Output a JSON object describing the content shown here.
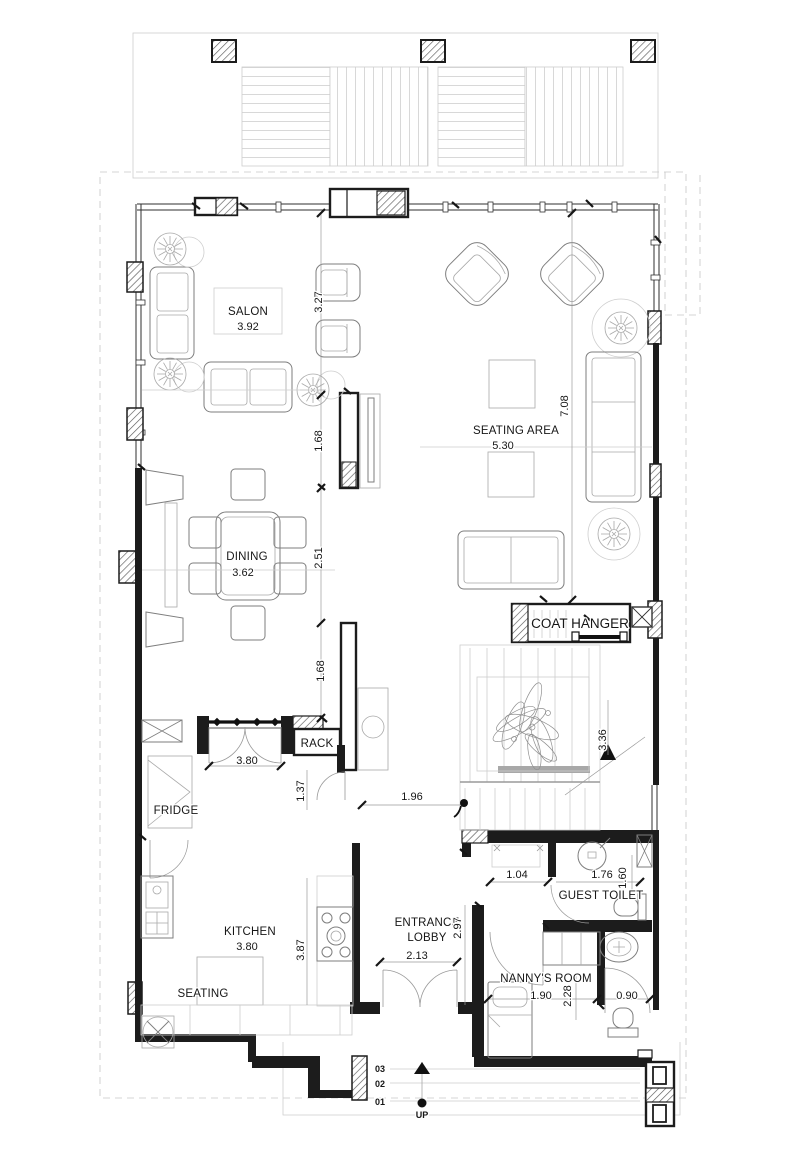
{
  "colors": {
    "background": "#ffffff",
    "walls": "#1c1c1c",
    "furniture_lines": "#7e7e7e",
    "light_lines": "#cecece",
    "text": "#161616"
  },
  "rooms": {
    "salon": {
      "name": "SALON",
      "width": "3.92"
    },
    "seating_area": {
      "name": "SEATING AREA",
      "width": "5.30",
      "depth": "7.08"
    },
    "dining": {
      "name": "DINING",
      "width": "3.62"
    },
    "kitchen": {
      "name": "KITCHEN",
      "width": "3.80",
      "depth": "3.87"
    },
    "kitchen_seating": {
      "name": "SEATING"
    },
    "entrance_lobby": {
      "name_line1": "ENTRANCE",
      "name_line2": "LOBBY",
      "width": "2.13",
      "depth": "2.97"
    },
    "nannys_room": {
      "name": "NANNY'S ROOM",
      "width": "1.90",
      "depth": "2.28"
    },
    "guest_toilet": {
      "name": "GUEST TOILET"
    },
    "coat_hanger": {
      "name": "COAT HANGER"
    },
    "rack": {
      "name": "RACK",
      "width": "3.80"
    },
    "fridge": {
      "name": "FRIDGE"
    }
  },
  "dimensions": {
    "salon_depth_upper": "3.27",
    "tv_wall": "1.68",
    "dining_depth": "2.51",
    "lower_wall": "1.68",
    "stair_width": "3.36",
    "hall_passage": "1.37",
    "hall_width": "1.96",
    "toilet_lobby": "1.04",
    "toilet_width": "1.76",
    "toilet_depth": "1.60",
    "nanny_bath_door": "0.90"
  },
  "entrance_steps": {
    "step_3": "03",
    "step_2": "02",
    "step_1": "01",
    "direction": "UP"
  }
}
